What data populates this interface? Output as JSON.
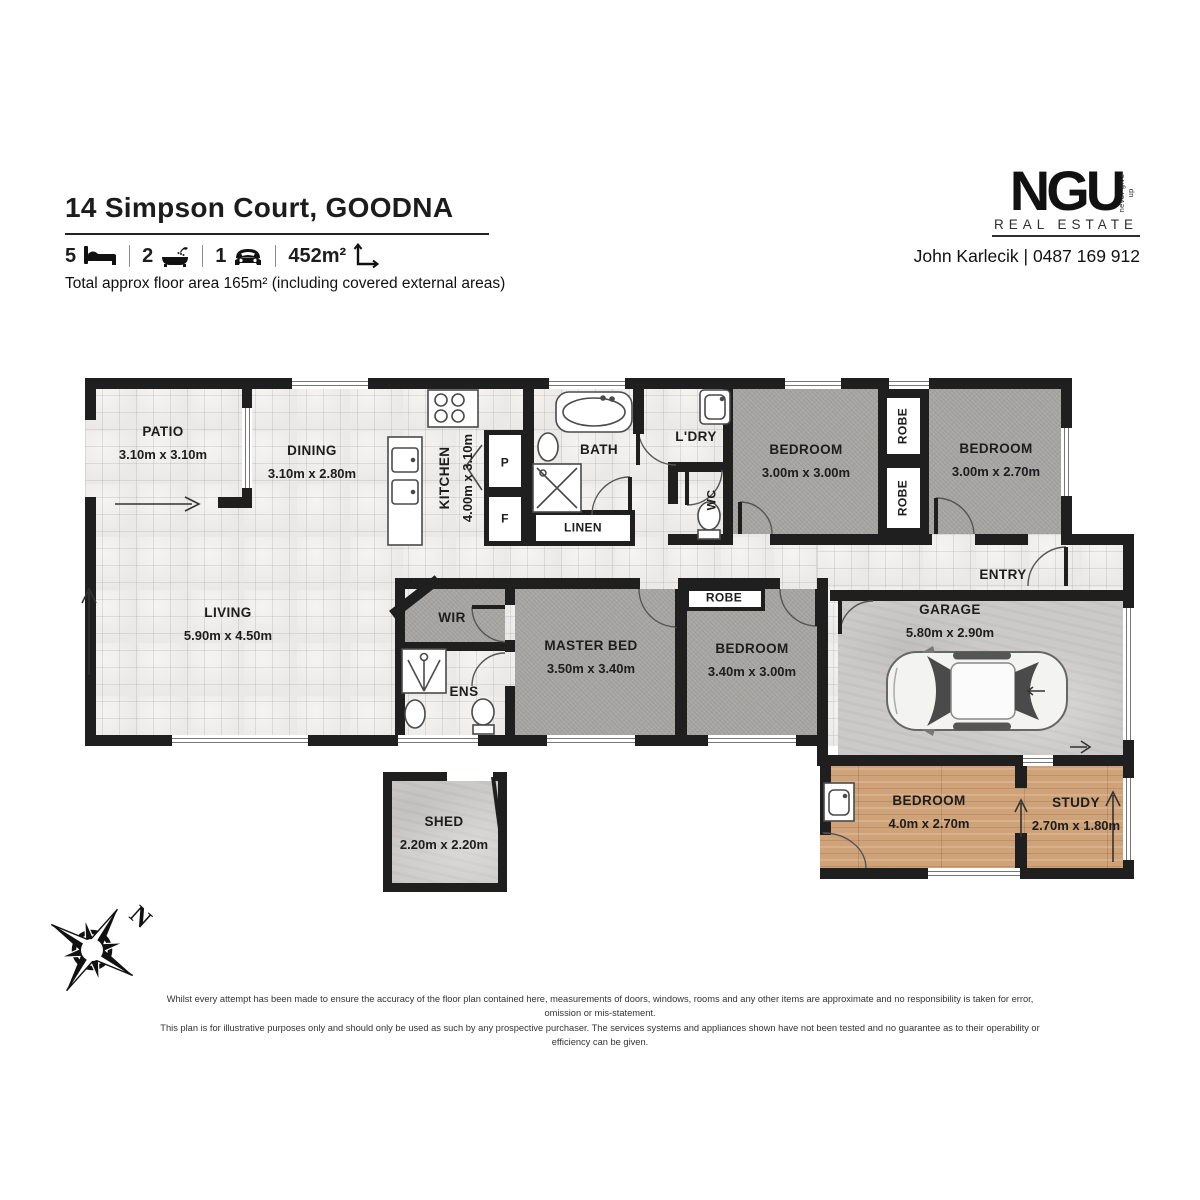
{
  "header": {
    "title": "14 Simpson Court, GOODNA",
    "stats": {
      "beds": "5",
      "baths": "2",
      "cars": "1",
      "land": "452m²"
    },
    "floor_area_note": "Total approx floor area 165m² (including covered external areas)",
    "brand": {
      "name": "NGU",
      "tagline": "never give up",
      "sub": "REAL ESTATE"
    },
    "agent": "John Karlecik | 0487 169 912"
  },
  "rooms": {
    "patio": {
      "name": "PATIO",
      "dims": "3.10m x 3.10m"
    },
    "dining": {
      "name": "DINING",
      "dims": "3.10m x 2.80m"
    },
    "kitchen": {
      "name": "KITCHEN",
      "dims": "4.00m x 3.10m"
    },
    "pantry": {
      "name": "P"
    },
    "fridge": {
      "name": "F"
    },
    "bath": {
      "name": "BATH"
    },
    "linen": {
      "name": "LINEN"
    },
    "ldry": {
      "name": "L'DRY"
    },
    "wc": {
      "name": "WC"
    },
    "bed2": {
      "name": "BEDROOM",
      "dims": "3.00m x 3.00m"
    },
    "robe_a": {
      "name": "ROBE"
    },
    "robe_b": {
      "name": "ROBE"
    },
    "bed3": {
      "name": "BEDROOM",
      "dims": "3.00m x 2.70m"
    },
    "living": {
      "name": "LIVING",
      "dims": "5.90m x 4.50m"
    },
    "wir": {
      "name": "WIR"
    },
    "ens": {
      "name": "ENS"
    },
    "master": {
      "name": "MASTER BED",
      "dims": "3.50m x 3.40m"
    },
    "robe_c": {
      "name": "ROBE"
    },
    "bed4": {
      "name": "BEDROOM",
      "dims": "3.40m x 3.00m"
    },
    "entry": {
      "name": "ENTRY"
    },
    "garage": {
      "name": "GARAGE",
      "dims": "5.80m x 2.90m"
    },
    "bed5": {
      "name": "BEDROOM",
      "dims": "4.0m x 2.70m"
    },
    "study": {
      "name": "STUDY",
      "dims": "2.70m x 1.80m"
    },
    "shed": {
      "name": "SHED",
      "dims": "2.20m x 2.20m"
    }
  },
  "compass": {
    "north_label": "N"
  },
  "disclaimer": {
    "line1": "Whilst every attempt has been made to ensure the accuracy of the floor plan contained here, measurements of doors, windows, rooms and any other items are approximate and no responsibility is taken for error, omission or mis-statement.",
    "line2": "This plan is for illustrative purposes only and should only be used as such by any prospective purchaser. The services systems and appliances shown have not been tested and no guarantee as to their operability or efficiency can be given."
  }
}
